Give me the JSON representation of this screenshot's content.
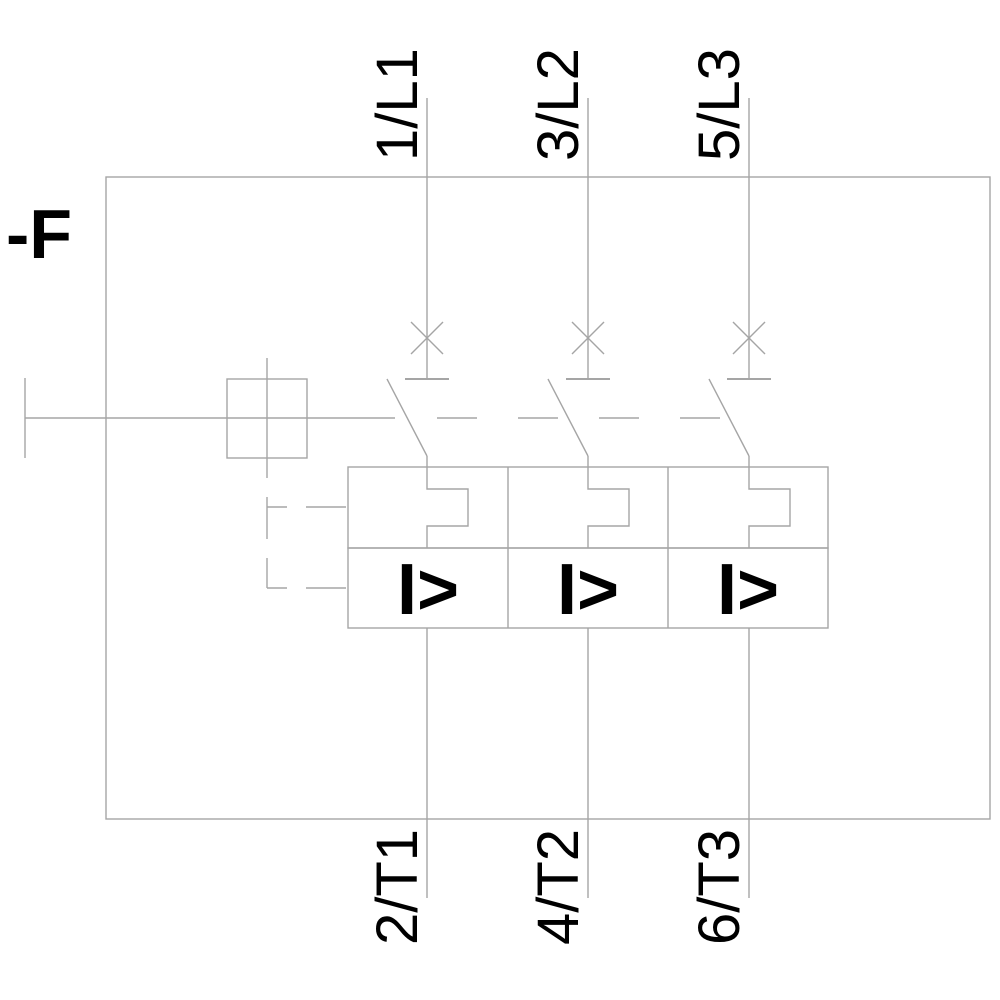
{
  "device_label": "-F",
  "poles": [
    {
      "top_terminal": "1/L1",
      "bottom_terminal": "2/T1",
      "magnetic_trip_symbol": "I>"
    },
    {
      "top_terminal": "3/L2",
      "bottom_terminal": "4/T2",
      "magnetic_trip_symbol": "I>"
    },
    {
      "top_terminal": "5/L3",
      "bottom_terminal": "6/T3",
      "magnetic_trip_symbol": "I>"
    }
  ],
  "colors": {
    "line": "#a5a5a5",
    "text": "#000000",
    "background": "#ffffff"
  }
}
